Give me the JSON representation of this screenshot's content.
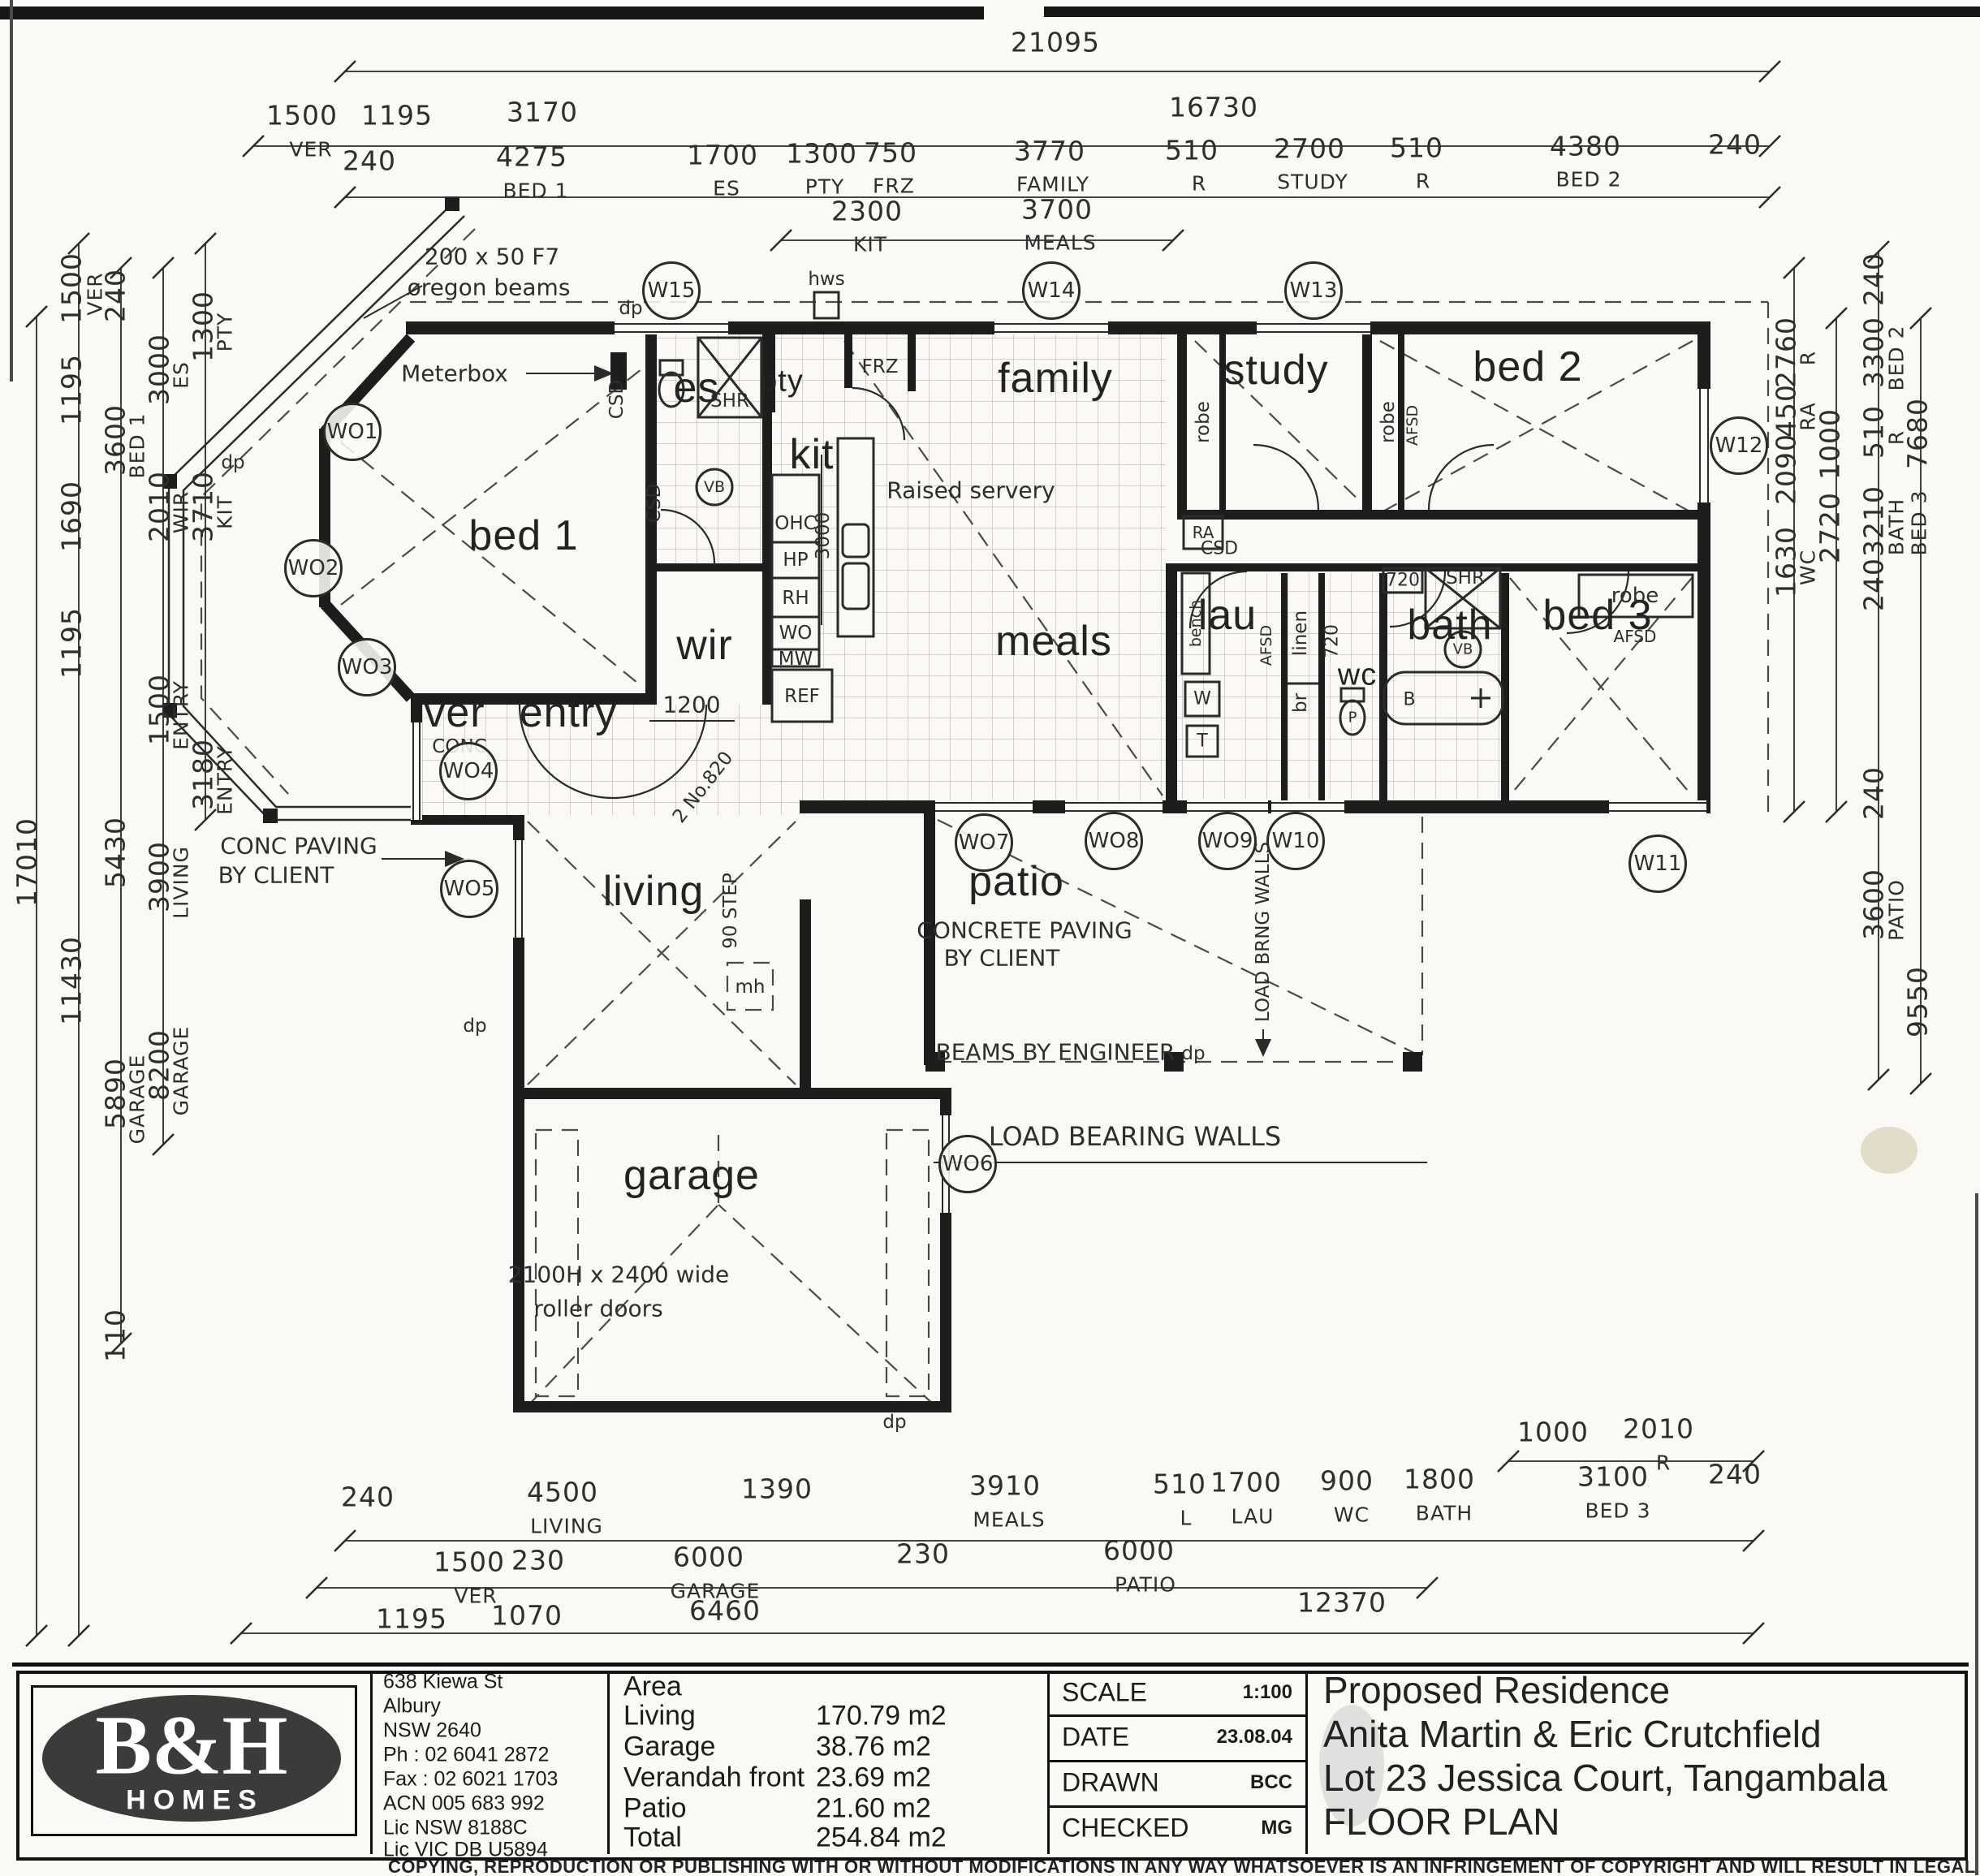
{
  "plan": {
    "rooms": {
      "bed1": "bed 1",
      "es": "es",
      "wir": "wir",
      "ver": "ver",
      "ver_sub": "CONC",
      "entry": "entry",
      "living": "living",
      "garage": "garage",
      "kit": "kit",
      "pty": "pty",
      "family": "family",
      "meals": "meals",
      "study": "study",
      "bed2": "bed 2",
      "bed3": "bed 3",
      "bath": "bath",
      "lau": "lau",
      "wc": "wc",
      "patio": "patio"
    },
    "fixtures": {
      "shr": "SHR",
      "vb": "VB",
      "ohc": "OHC",
      "hp": "HP",
      "rh": "RH",
      "wo": "WO",
      "mw": "MW",
      "ref": "REF",
      "frz": "FRZ",
      "robe": "robe",
      "afsd": "AFSD",
      "ra": "RA",
      "csd": "CSD",
      "linen": "linen",
      "br": "br",
      "bench": "bench",
      "w": "W",
      "t": "T",
      "p": "P",
      "b": "B"
    },
    "windows": {
      "wo1": "WO1",
      "wo2": "WO2",
      "wo3": "WO3",
      "wo4": "WO4",
      "wo5": "WO5",
      "wo6": "WO6",
      "wo7": "WO7",
      "wo8": "WO8",
      "wo9": "WO9",
      "w10": "W10",
      "w11": "W11",
      "w12": "W12",
      "w13": "W13",
      "w14": "W14",
      "w15": "W15"
    },
    "notes": {
      "beams1": "200 x 50 F7",
      "beams2": "oregon beams",
      "meterbox": "Meterbox",
      "hws": "hws",
      "servery": "Raised servery",
      "conc1": "CONC PAVING",
      "conc2": "BY CLIENT",
      "concrete1": "CONCRETE PAVING",
      "concrete2": "BY CLIENT",
      "beams_eng": "BEAMS BY ENGINEER",
      "lbw": "LOAD BEARING WALLS",
      "lbw_v": "LOAD BRNG WALLS",
      "roller1": "2100H x 2400 wide",
      "roller2": "roller doors",
      "step": "90 STEP",
      "mh": "mh",
      "dp": "dp",
      "door_note": "2 No.820",
      "dim_3000": "3000",
      "dim_1200": "1200",
      "dim_720": "720"
    }
  },
  "dims": {
    "top_total": "21095",
    "t2": [
      [
        "1500",
        "VER"
      ],
      [
        "1195",
        ""
      ],
      [
        "3170",
        ""
      ],
      [
        "16730",
        ""
      ]
    ],
    "t3": [
      [
        "240",
        ""
      ],
      [
        "4275",
        "BED 1"
      ],
      [
        "1700",
        "ES"
      ],
      [
        "1300",
        "PTY"
      ],
      [
        "750",
        "FRZ"
      ],
      [
        "3770",
        "FAMILY"
      ],
      [
        "510",
        "R"
      ],
      [
        "2700",
        "STUDY"
      ],
      [
        "510",
        "R"
      ],
      [
        "4380",
        "BED 2"
      ],
      [
        "240",
        ""
      ]
    ],
    "t4": [
      [
        "2300",
        "KIT"
      ],
      [
        "3700",
        "MEALS"
      ]
    ],
    "l1": [
      [
        "17010",
        ""
      ]
    ],
    "l2": [
      [
        "1500",
        "VER"
      ],
      [
        "1195",
        ""
      ],
      [
        "1690",
        ""
      ],
      [
        "1195",
        ""
      ],
      [
        "11430",
        ""
      ]
    ],
    "l3": [
      [
        "240",
        ""
      ],
      [
        "3600",
        "BED 1"
      ],
      [
        "5430",
        ""
      ],
      [
        "5890",
        "GARAGE"
      ],
      [
        "110",
        ""
      ]
    ],
    "l4": [
      [
        "3000",
        "ES"
      ],
      [
        "2010",
        "WIR"
      ],
      [
        "1500",
        "ENTRY"
      ],
      [
        "3900",
        "LIVING"
      ],
      [
        "8200",
        "GARAGE"
      ]
    ],
    "l5": [
      [
        "1300",
        "PTY"
      ],
      [
        "3710",
        "KIT"
      ],
      [
        "3180",
        "ENTRY"
      ]
    ],
    "r1": [
      [
        "2760",
        "R"
      ],
      [
        "450",
        "RA"
      ],
      [
        "2090",
        ""
      ],
      [
        "1630",
        "WC"
      ]
    ],
    "r2": [
      [
        "1000",
        ""
      ],
      [
        "2720",
        ""
      ]
    ],
    "r3": [
      [
        "240",
        ""
      ],
      [
        "3300",
        "BED 2"
      ],
      [
        "510",
        "R"
      ],
      [
        "3210",
        "BATH"
      ],
      [
        "240",
        ""
      ],
      [
        "240",
        ""
      ],
      [
        "3600",
        "PATIO"
      ]
    ],
    "r4": [
      [
        "7680",
        ""
      ],
      [
        "BED 3",
        ""
      ],
      [
        "9550",
        ""
      ]
    ],
    "b0": [
      [
        "1000",
        ""
      ],
      [
        "2010",
        "R"
      ]
    ],
    "b1": [
      [
        "240",
        ""
      ],
      [
        "4500",
        "LIVING"
      ],
      [
        "1390",
        ""
      ],
      [
        "3910",
        "MEALS"
      ],
      [
        "510",
        "L"
      ],
      [
        "1700",
        "LAU"
      ],
      [
        "900",
        "WC"
      ],
      [
        "1800",
        "BATH"
      ],
      [
        "3100",
        "BED 3"
      ],
      [
        "240",
        ""
      ]
    ],
    "b2": [
      [
        "1500",
        "VER"
      ],
      [
        "230",
        ""
      ],
      [
        "6000",
        "GARAGE"
      ],
      [
        "230",
        ""
      ],
      [
        "6000",
        "PATIO"
      ]
    ],
    "b3": [
      [
        "1195",
        ""
      ],
      [
        "1070",
        ""
      ],
      [
        "6460",
        ""
      ],
      [
        "12370",
        ""
      ]
    ]
  },
  "title_block": {
    "logo_main": "B&H",
    "logo_sub": "HOMES",
    "address": [
      "638 Kiewa St",
      "Albury",
      "NSW 2640",
      "Ph :  02 6041 2872",
      "Fax : 02 6021 1703",
      "ACN 005 683 992"
    ],
    "licences": [
      "Lic NSW 8188C",
      "Lic VIC DB U5894"
    ],
    "area_heading": "Area",
    "area_rows": [
      {
        "label": "Living",
        "value": "170.79 m2"
      },
      {
        "label": "Garage",
        "value": "38.76 m2"
      },
      {
        "label": "Verandah front",
        "value": "23.69 m2"
      },
      {
        "label": "Patio",
        "value": "21.60 m2"
      },
      {
        "label": "Total",
        "value": "254.84 m2"
      }
    ],
    "meta": [
      {
        "label": "SCALE",
        "value": "1:100"
      },
      {
        "label": "DATE",
        "value": "23.08.04"
      },
      {
        "label": "DRAWN",
        "value": "BCC"
      },
      {
        "label": "CHECKED",
        "value": "MG"
      }
    ],
    "project": [
      "Proposed Residence",
      "Anita Martin & Eric Crutchfield",
      "Lot 23 Jessica Court, Tangambala",
      "FLOOR PLAN"
    ],
    "copyright": "COPYING, REPRODUCTION OR PUBLISHING WITH OR WITHOUT MODIFICATIONS IN ANY WAY WHATSOEVER IS AN INFRINGEMENT OF COPYRIGHT AND WILL RESULT IN LEGAL ACTION"
  }
}
